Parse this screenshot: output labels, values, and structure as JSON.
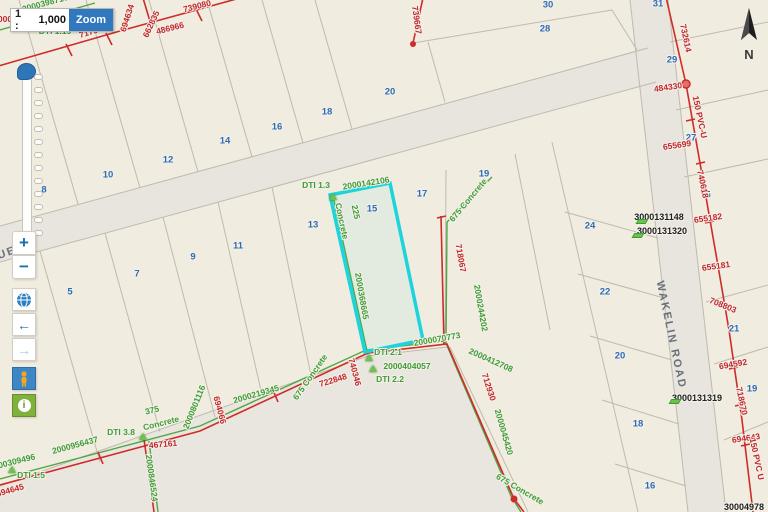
{
  "scale_control": {
    "prefix": "1 :",
    "value": "1,000",
    "button": "Zoom"
  },
  "compass": {
    "label": "N"
  },
  "toolbar": {
    "zoom_in": "+",
    "zoom_out": "−",
    "back_arrow": "←",
    "forward_arrow": "→",
    "info_glyph": "i"
  },
  "map": {
    "lots": [
      {
        "t": "8",
        "x": 44,
        "y": 190
      },
      {
        "t": "10",
        "x": 108,
        "y": 175
      },
      {
        "t": "12",
        "x": 168,
        "y": 160
      },
      {
        "t": "14",
        "x": 225,
        "y": 141
      },
      {
        "t": "16",
        "x": 277,
        "y": 127
      },
      {
        "t": "18",
        "x": 327,
        "y": 112
      },
      {
        "t": "20",
        "x": 390,
        "y": 92
      },
      {
        "t": "28",
        "x": 545,
        "y": 29
      },
      {
        "t": "30",
        "x": 548,
        "y": 5
      },
      {
        "t": "31",
        "x": 658,
        "y": 4
      },
      {
        "t": "29",
        "x": 672,
        "y": 60
      },
      {
        "t": "27",
        "x": 691,
        "y": 138
      },
      {
        "t": "5",
        "x": 708,
        "y": 195
      },
      {
        "t": "5",
        "x": 70,
        "y": 292
      },
      {
        "t": "7",
        "x": 137,
        "y": 274
      },
      {
        "t": "9",
        "x": 193,
        "y": 257
      },
      {
        "t": "11",
        "x": 238,
        "y": 246
      },
      {
        "t": "13",
        "x": 313,
        "y": 225
      },
      {
        "t": "15",
        "x": 372,
        "y": 209
      },
      {
        "t": "17",
        "x": 422,
        "y": 194
      },
      {
        "t": "19",
        "x": 484,
        "y": 174
      },
      {
        "t": "24",
        "x": 590,
        "y": 226
      },
      {
        "t": "22",
        "x": 605,
        "y": 292
      },
      {
        "t": "20",
        "x": 620,
        "y": 356
      },
      {
        "t": "18",
        "x": 638,
        "y": 424
      },
      {
        "t": "16",
        "x": 650,
        "y": 486
      },
      {
        "t": "21",
        "x": 734,
        "y": 329
      },
      {
        "t": "19",
        "x": 752,
        "y": 389
      }
    ],
    "red": [
      {
        "t": "717937",
        "x": 93,
        "y": 31,
        "r": -17
      },
      {
        "t": "694634",
        "x": 127,
        "y": 18,
        "r": -72
      },
      {
        "t": "662835",
        "x": 151,
        "y": 24,
        "r": -65
      },
      {
        "t": "486966",
        "x": 170,
        "y": 28,
        "r": -14
      },
      {
        "t": "739080",
        "x": 197,
        "y": 6,
        "r": -14
      },
      {
        "t": "739667",
        "x": 417,
        "y": 20,
        "r": 82
      },
      {
        "t": "732614",
        "x": 686,
        "y": 38,
        "r": 78
      },
      {
        "t": "484330",
        "x": 668,
        "y": 87,
        "r": -8
      },
      {
        "t": "150 PVC-U",
        "x": 700,
        "y": 117,
        "r": 78
      },
      {
        "t": "655699",
        "x": 677,
        "y": 145,
        "r": -8
      },
      {
        "t": "740618",
        "x": 703,
        "y": 184,
        "r": 78
      },
      {
        "t": "655182",
        "x": 708,
        "y": 218,
        "r": -8
      },
      {
        "t": "655181",
        "x": 716,
        "y": 266,
        "r": -8
      },
      {
        "t": "708803",
        "x": 723,
        "y": 305,
        "r": 22
      },
      {
        "t": "694592",
        "x": 733,
        "y": 364,
        "r": -10
      },
      {
        "t": "718670",
        "x": 742,
        "y": 401,
        "r": 78
      },
      {
        "t": "694643",
        "x": 746,
        "y": 438,
        "r": -8
      },
      {
        "t": "150 PVC U",
        "x": 757,
        "y": 459,
        "r": 78
      },
      {
        "t": "467161",
        "x": 163,
        "y": 444,
        "r": -5
      },
      {
        "t": "694645",
        "x": 10,
        "y": 490,
        "r": -16
      },
      {
        "t": "694066",
        "x": 220,
        "y": 410,
        "r": 75
      },
      {
        "t": "722848",
        "x": 333,
        "y": 380,
        "r": -17
      },
      {
        "t": "740346",
        "x": 355,
        "y": 372,
        "r": 75
      },
      {
        "t": "712930",
        "x": 489,
        "y": 387,
        "r": 72
      },
      {
        "t": "718067",
        "x": 461,
        "y": 258,
        "r": 80
      },
      {
        "t": "000",
        "x": 5,
        "y": 19,
        "r": 0
      }
    ],
    "green": [
      {
        "t": "2000398710",
        "x": 45,
        "y": 3,
        "r": -15
      },
      {
        "t": "DTI 1.19",
        "x": 55,
        "y": 31,
        "r": 0
      },
      {
        "t": "DTI 1.3",
        "x": 316,
        "y": 185,
        "r": 0
      },
      {
        "t": "2000142106",
        "x": 366,
        "y": 183,
        "r": -9
      },
      {
        "t": "225",
        "x": 356,
        "y": 212,
        "r": 78
      },
      {
        "t": "Concrete",
        "x": 342,
        "y": 221,
        "r": 78
      },
      {
        "t": "2000368665",
        "x": 362,
        "y": 296,
        "r": 80
      },
      {
        "t": "DTI 2.1",
        "x": 388,
        "y": 352,
        "r": 0
      },
      {
        "t": "2000070773",
        "x": 437,
        "y": 339,
        "r": -10
      },
      {
        "t": "2000404057",
        "x": 407,
        "y": 366,
        "r": 0
      },
      {
        "t": "DTI 2.2",
        "x": 390,
        "y": 379,
        "r": 0
      },
      {
        "t": "2000412708",
        "x": 491,
        "y": 360,
        "r": 24
      },
      {
        "t": "2000045420",
        "x": 504,
        "y": 432,
        "r": 74
      },
      {
        "t": "675 Concrete",
        "x": 520,
        "y": 489,
        "r": 30
      },
      {
        "t": "675 Concrete",
        "x": 468,
        "y": 200,
        "r": -50
      },
      {
        "t": "2000244202",
        "x": 481,
        "y": 308,
        "r": 80
      },
      {
        "t": "675 Concrete",
        "x": 310,
        "y": 377,
        "r": -55
      },
      {
        "t": "2000219345",
        "x": 256,
        "y": 394,
        "r": -16
      },
      {
        "t": "2000801116",
        "x": 194,
        "y": 407,
        "r": -68
      },
      {
        "t": "2000956437",
        "x": 75,
        "y": 445,
        "r": -15
      },
      {
        "t": "DTI 3.8",
        "x": 121,
        "y": 432,
        "r": 0
      },
      {
        "t": "375",
        "x": 152,
        "y": 410,
        "r": -14
      },
      {
        "t": "Concrete",
        "x": 161,
        "y": 423,
        "r": -14
      },
      {
        "t": "2000309496",
        "x": 12,
        "y": 462,
        "r": -14
      },
      {
        "t": "DTI 1.5",
        "x": 31,
        "y": 475,
        "r": 0
      },
      {
        "t": "2000846524",
        "x": 152,
        "y": 478,
        "r": 82
      }
    ],
    "black": [
      {
        "t": "3000131148",
        "x": 659,
        "y": 217,
        "r": 0
      },
      {
        "t": "3000131320",
        "x": 662,
        "y": 231,
        "r": 0
      },
      {
        "t": "3000131319",
        "x": 697,
        "y": 398,
        "r": 0
      },
      {
        "t": "30004978",
        "x": 744,
        "y": 507,
        "r": 0
      }
    ],
    "roads": [
      {
        "t": "WAKELIN ROAD",
        "x": 671,
        "y": 335,
        "r": 78
      },
      {
        "t": "UE",
        "x": 7,
        "y": 253,
        "r": -20
      }
    ],
    "markers_tri": [
      [
        333,
        197
      ],
      [
        369,
        358
      ],
      [
        373,
        369
      ],
      [
        143,
        437
      ],
      [
        12,
        470
      ]
    ],
    "markers_dash": [
      [
        641,
        221
      ],
      [
        637,
        235
      ],
      [
        674,
        401
      ]
    ]
  },
  "colors": {
    "highlight": "#1ed4dc",
    "water_red": "#cf2b28",
    "sewer_green": "#52a646",
    "parcel_line": "#bfbab0",
    "road_fill": "#e8e5de",
    "parcel_fill": "#f0ece0"
  }
}
